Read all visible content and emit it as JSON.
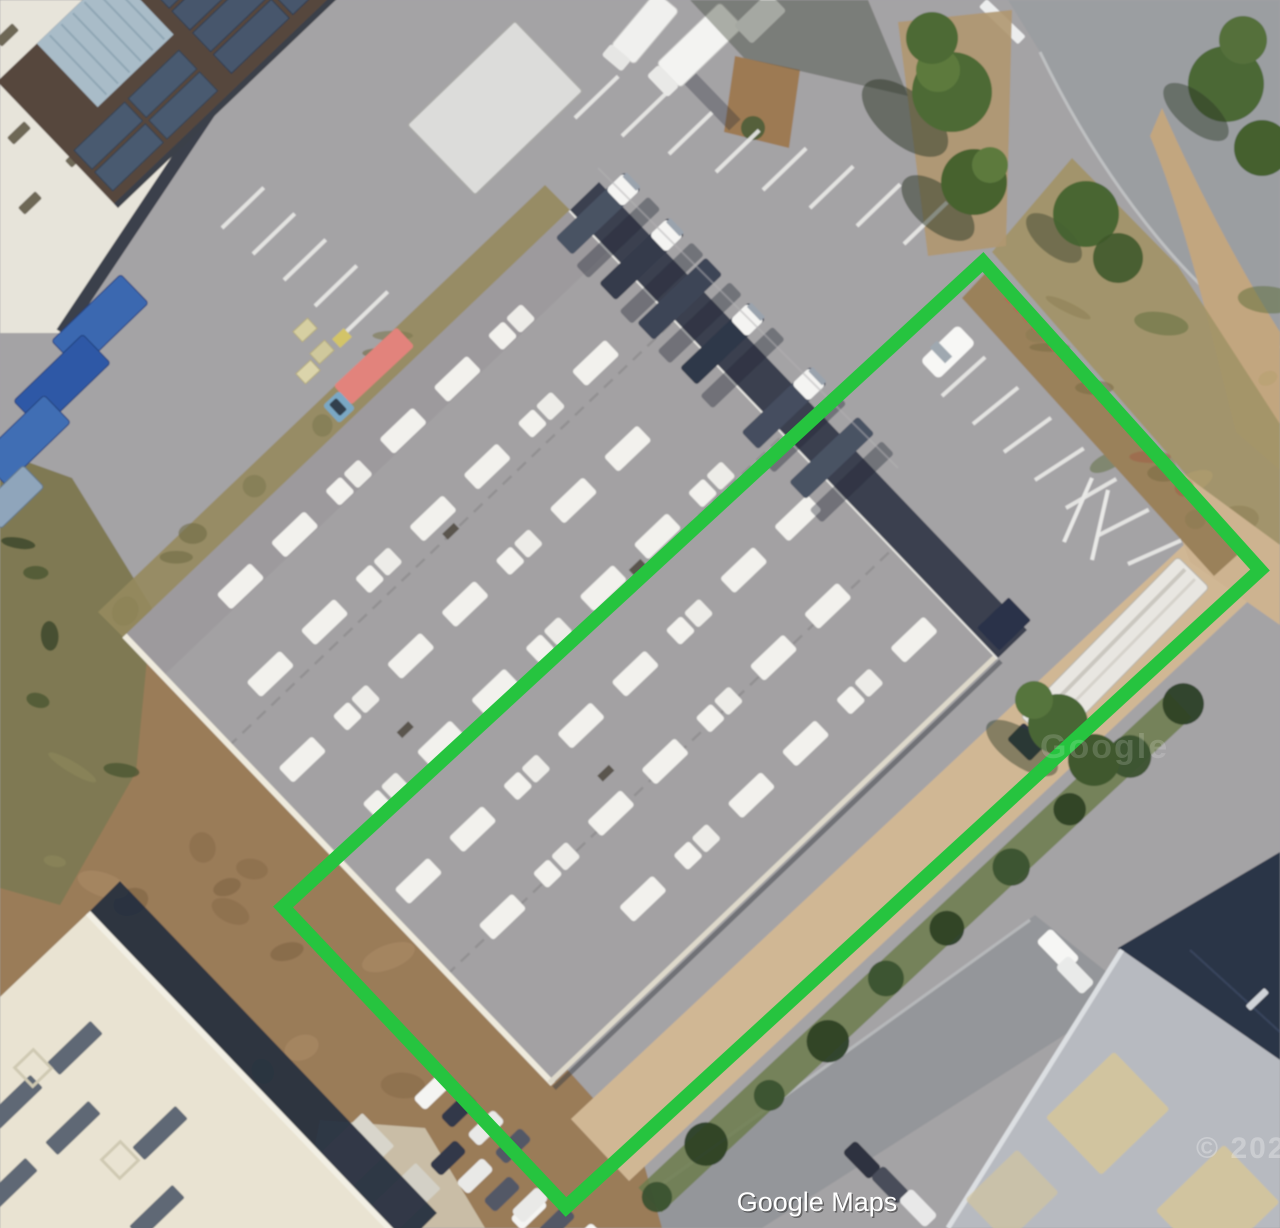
{
  "attribution": {
    "label": "Google Maps"
  },
  "watermarks": {
    "brand": "Google",
    "year": "© 2021"
  },
  "annotation": {
    "name": "property-boundary",
    "shape": "rotated-rectangle",
    "points": "983,262 1260,570 566,1207 283,907",
    "stroke_color": "#26c43f",
    "stroke_width": 14
  },
  "map": {
    "view_type": "satellite-aerial",
    "colors": {
      "asphalt": "#a4a3a5",
      "road": "#9b9ea1",
      "warehouse_roof": "#a3a1a3",
      "skylight_white": "#f2f1ed",
      "dirt": "#9a7b58",
      "sand_path": "#d0b794",
      "vegetation": "#4c6836",
      "shadow_navy": "#2b3447",
      "container_blue": "#3a68b0",
      "cream_roof": "#e9e3d2",
      "boundary_green": "#26c43f"
    },
    "features": [
      {
        "name": "warehouse-building",
        "desc": "large gray roof with rows of white skylights"
      },
      {
        "name": "loading-dock-trucks",
        "desc": "white-cab trucks docked on north-east face"
      },
      {
        "name": "solar-roof-building",
        "desc": "dark roof with blue solar panel arrays"
      },
      {
        "name": "white-industrial-building",
        "desc": "white roof with dark vent slashes, top-left"
      },
      {
        "name": "shipping-containers",
        "desc": "blue containers, left edge"
      },
      {
        "name": "cream-roof-building",
        "desc": "bottom-left cream roof with dark skylight strips"
      },
      {
        "name": "gray-roof-building",
        "desc": "bottom-right light gray roof with tan patches"
      },
      {
        "name": "parking-lot",
        "desc": "white-striped parking rows and parked cars"
      },
      {
        "name": "semi-trailer",
        "desc": "white trailer parked near right side"
      },
      {
        "name": "red-truck",
        "desc": "red trailer with blue cab near warehouse corner"
      },
      {
        "name": "hedgerow-and-trees",
        "desc": "green vegetation along roads"
      },
      {
        "name": "sand-path",
        "desc": "sandy strip along south-east boundary"
      },
      {
        "name": "property-boundary",
        "desc": "green rotated rectangle annotation"
      }
    ]
  }
}
